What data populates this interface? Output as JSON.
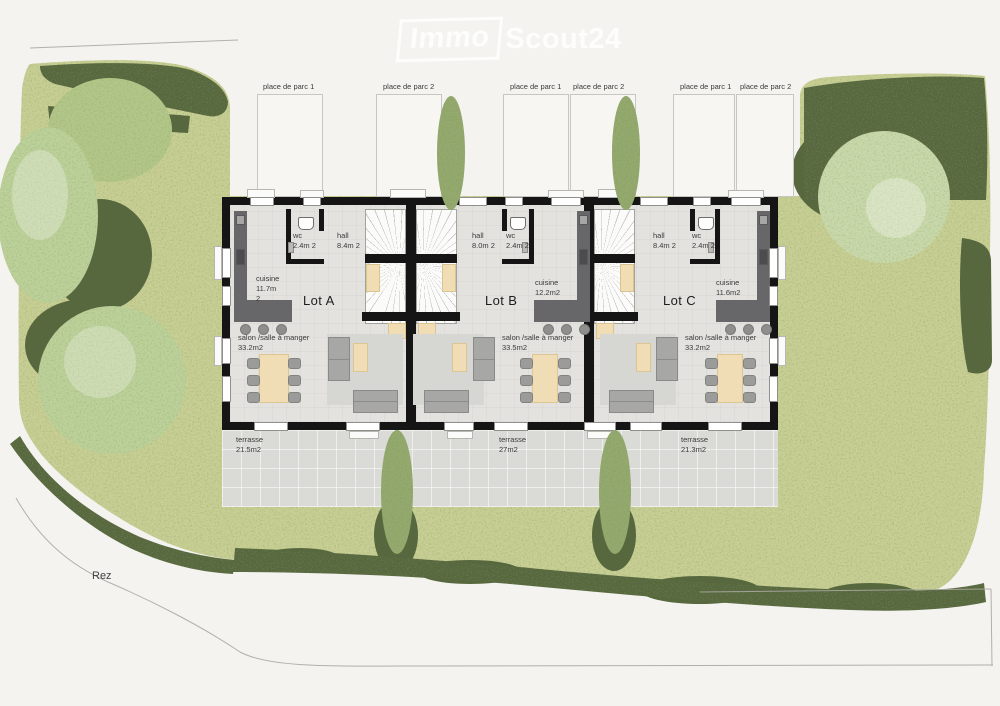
{
  "watermark": {
    "brand_left": "Immo",
    "brand_right": "Scout24"
  },
  "site": {
    "floor_label": "Rez"
  },
  "parking": {
    "labels": [
      "place de parc 1",
      "place de parc 2",
      "place de parc 1",
      "place de parc 2",
      "place de parc 1",
      "place de parc 2"
    ]
  },
  "units": [
    {
      "name": "Lot A",
      "wc": "wc\n2.4m 2",
      "hall": "hall\n8.4m 2",
      "cuisine": "cuisine\n11.7m\n2",
      "salon": "salon /salle à manger\n33.2m2",
      "terrasse": "terrasse\n21.5m2"
    },
    {
      "name": "Lot B",
      "wc": "wc\n2.4m 2",
      "hall": "hall\n8.0m 2",
      "cuisine": "cuisine\n12.2m2",
      "salon": "salon /salle à manger\n33.5m2",
      "terrasse": "terrasse\n27m2"
    },
    {
      "name": "Lot C",
      "wc": "wc\n2.4m 2",
      "hall": "hall\n8.4m 2",
      "cuisine": "cuisine\n11.6m2",
      "salon": "salon /salle à manger\n33.2m2",
      "terrasse": "terrasse\n21.3m2"
    }
  ],
  "colors": {
    "garden_light": "#c6cd92",
    "hedge_dark": "#57683e",
    "tree_pale": "#bcd09a",
    "wall": "#151515",
    "floor": "#e3e2df",
    "terrace": "#dadad6",
    "counter": "#67676a",
    "wood": "#f0ddb4",
    "sofa": "#a7a7a5"
  }
}
